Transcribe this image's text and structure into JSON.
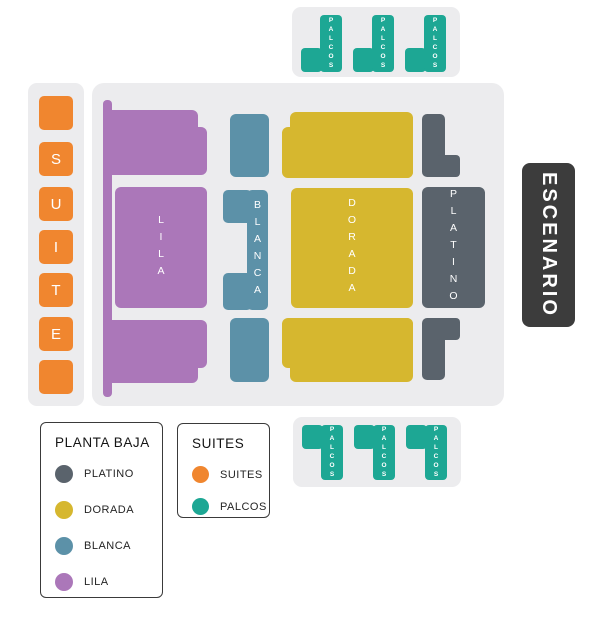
{
  "palette": {
    "suites_orange": "#F0862F",
    "palcos_teal": "#1DA794",
    "lila_purple": "#AB77B9",
    "blanca_blue": "#5C91A8",
    "dorada_yellow": "#D6B72F",
    "platino_gray": "#5A636C",
    "stage_dark": "#3C3C3C",
    "panel_gray": "#ECECEE"
  },
  "stage": {
    "label": "ESCENARIO"
  },
  "suite_column": {
    "letters": [
      "",
      "S",
      "U",
      "I",
      "T",
      "E",
      ""
    ]
  },
  "top_palcos": {
    "items": [
      "PALCOS",
      "PALCOS",
      "PALCOS"
    ]
  },
  "bottom_palcos": {
    "items": [
      "PALCOS",
      "PALCOS",
      "PALCOS"
    ]
  },
  "sections": {
    "lila": "LILA",
    "blanca": "BLANCA",
    "dorada": "DORADA",
    "platino": "PLATINO"
  },
  "legends": {
    "planta_baja": {
      "title": "PLANTA BAJA",
      "items": [
        {
          "label": "PLATINO",
          "color": "#5A636C"
        },
        {
          "label": "DORADA",
          "color": "#D6B72F"
        },
        {
          "label": "BLANCA",
          "color": "#5C91A8"
        },
        {
          "label": "LILA",
          "color": "#AB77B9"
        }
      ]
    },
    "suites": {
      "title": "SUITES",
      "items": [
        {
          "label": "SUITES",
          "color": "#F0862F"
        },
        {
          "label": "PALCOS",
          "color": "#1DA794"
        }
      ]
    }
  }
}
